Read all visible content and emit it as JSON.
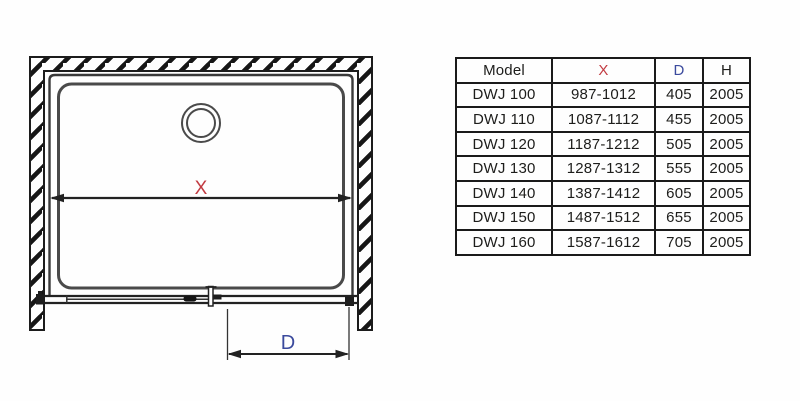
{
  "diagram": {
    "dimension_x_label": "X",
    "dimension_d_label": "D",
    "x_label_color": "#c23b42",
    "d_label_color": "#3b4a9d",
    "line_color": "#222222",
    "tray_line_color": "#4a4a4a"
  },
  "table": {
    "border_color": "#1a1a1a",
    "headers": [
      {
        "label": "Model",
        "color": "#1d1d1b"
      },
      {
        "label": "X",
        "color": "#c23b42"
      },
      {
        "label": "D",
        "color": "#3b4a9d"
      },
      {
        "label": "H",
        "color": "#1d1d1b"
      }
    ],
    "rows": [
      {
        "model": "DWJ 100",
        "x": "987-1012",
        "d": "405",
        "h": "2005"
      },
      {
        "model": "DWJ 110",
        "x": "1087-1112",
        "d": "455",
        "h": "2005"
      },
      {
        "model": "DWJ 120",
        "x": "1187-1212",
        "d": "505",
        "h": "2005"
      },
      {
        "model": "DWJ 130",
        "x": "1287-1312",
        "d": "555",
        "h": "2005"
      },
      {
        "model": "DWJ 140",
        "x": "1387-1412",
        "d": "605",
        "h": "2005"
      },
      {
        "model": "DWJ 150",
        "x": "1487-1512",
        "d": "655",
        "h": "2005"
      },
      {
        "model": "DWJ 160",
        "x": "1587-1612",
        "d": "705",
        "h": "2005"
      }
    ]
  }
}
